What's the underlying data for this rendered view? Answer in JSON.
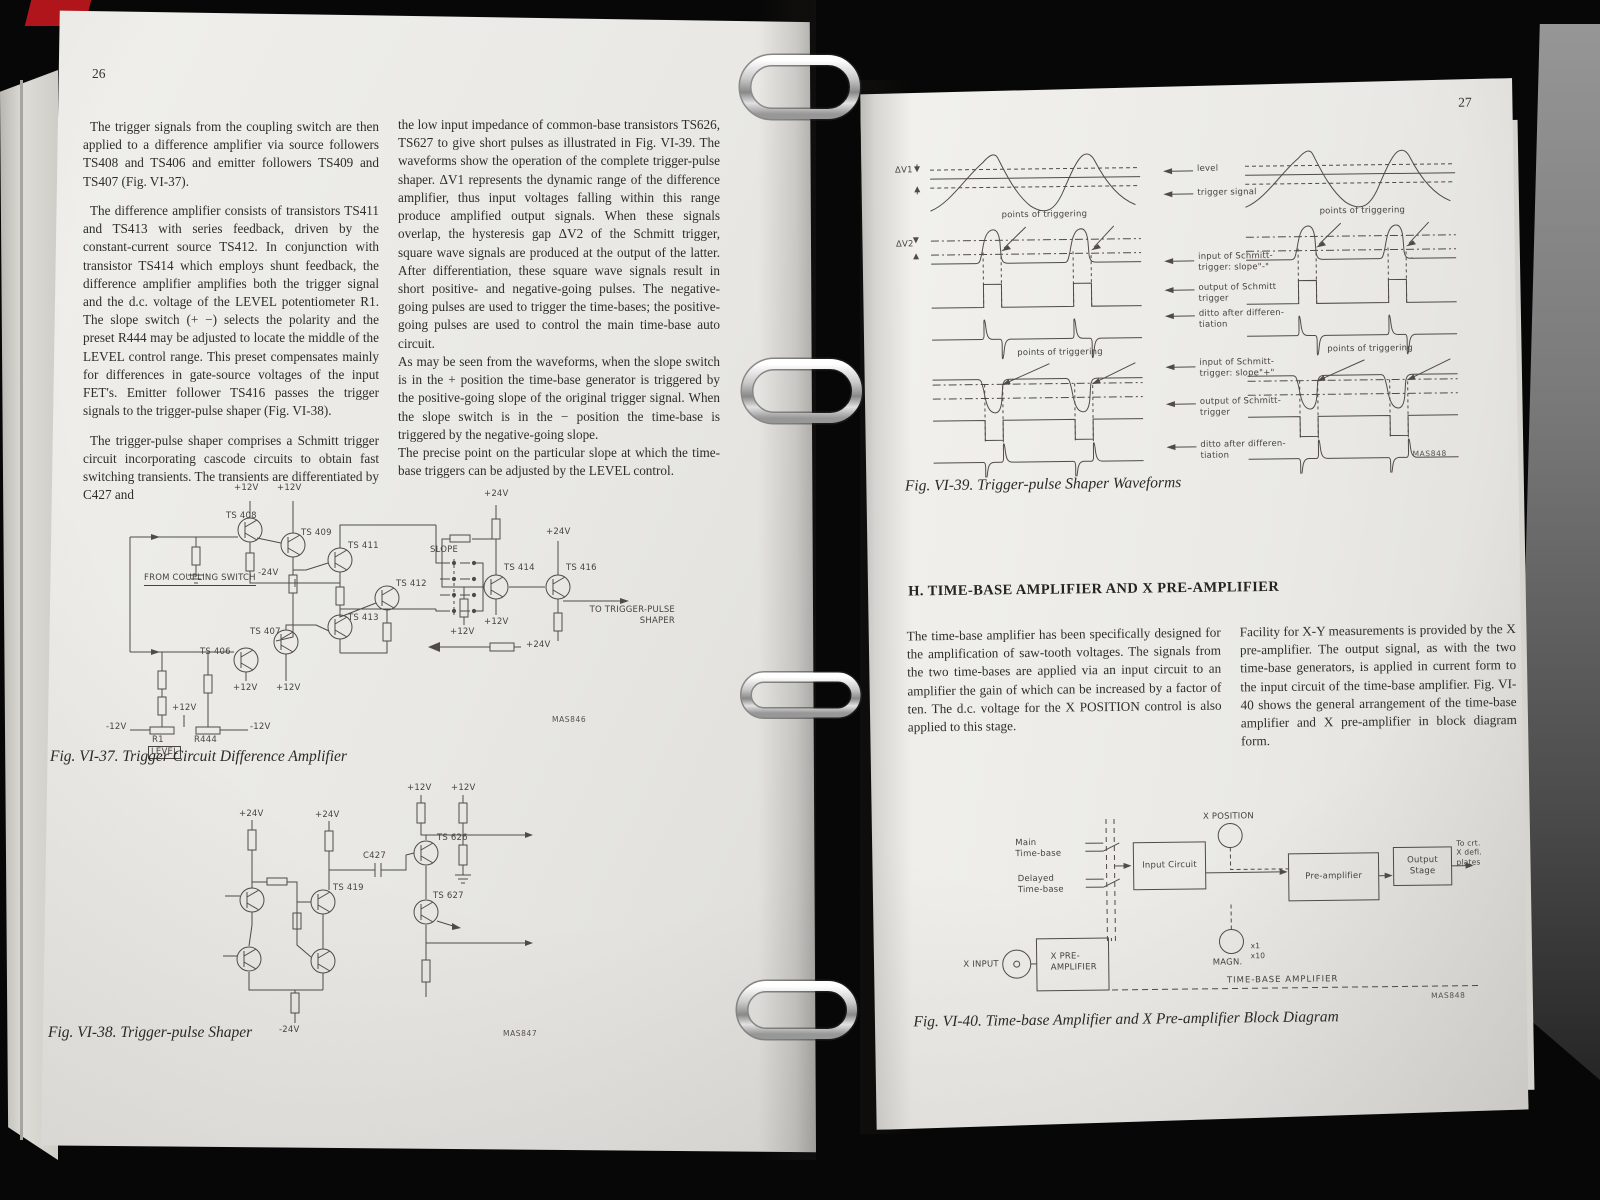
{
  "colors": {
    "binder_red": "#b0151c",
    "page": "#eae9e5",
    "background": "#070707",
    "ring_silver": "#c9c9c9"
  },
  "left_page": {
    "page_number": "26",
    "col1": [
      "The trigger signals from the coupling switch are then applied to a difference amplifier via source followers TS408 and TS406 and emitter followers TS409 and TS407 (Fig. VI-37).",
      "The difference amplifier consists of transistors TS411 and TS413 with series feedback, driven by the constant-current source TS412. In conjunction with transistor TS414 which employs shunt feedback, the difference amplifier amplifies both the trigger signal and the d.c. voltage of the LEVEL potentiometer R1. The slope switch (+ −) selects the polarity and the preset R444 may be adjusted to locate the middle of the LEVEL control range. This preset compensates mainly for differences in gate-source voltages of the input FET's. Emitter follower TS416 passes the trigger signals to the trigger-pulse shaper (Fig. VI-38).",
      "The trigger-pulse shaper comprises a Schmitt trigger circuit incorporating cascode circuits to obtain fast switching transients. The transients are differentiated by C427 and"
    ],
    "col2": [
      "the low input impedance of common-base transistors TS626, TS627 to give short pulses as illustrated in Fig. VI-39. The waveforms show the operation of the complete trigger-pulse shaper. ΔV1 represents the dynamic range of the difference amplifier, thus input voltages falling within this range produce amplified output signals. When these signals overlap, the hysteresis gap ΔV2 of the Schmitt trigger, square wave signals are produced at the output of the latter. After differentiation, these square wave signals result in short positive- and negative-going pulses. The negative-going pulses are used to trigger the time-bases; the positive-going pulses are used to control the main time-base auto circuit.",
      "As may be seen from the waveforms, when the slope switch is in the + position the time-base generator is triggered by the positive-going slope of the original trigger signal. When the slope switch is in the − position the time-base is triggered by the negative-going slope.",
      "The precise point on the particular slope at which the time-base triggers can be adjusted by the LEVEL control."
    ],
    "fig37": {
      "caption": "Fig. VI-37. Trigger Circuit Difference Amplifier",
      "code": "MAS846",
      "labels": {
        "from_coupling_switch": "FROM COUPLING SWITCH",
        "ts408": "TS 408",
        "ts409": "TS 409",
        "ts411": "TS 411",
        "ts412": "TS 412",
        "ts413": "TS 413",
        "ts406": "TS 406",
        "ts407": "TS 407",
        "ts414": "TS 414",
        "ts416": "TS 416",
        "slope": "SLOPE",
        "to_shaper": "TO TRIGGER-PULSE\nSHAPER",
        "v12p": "+12V",
        "v12n": "-12V",
        "v24p": "+24V",
        "v24n": "-24V",
        "r1": "R1",
        "r444": "R444",
        "level": "LEVEL"
      }
    },
    "fig38": {
      "caption": "Fig. VI-38. Trigger-pulse Shaper",
      "code": "MAS847",
      "labels": {
        "c427": "C427",
        "ts419": "TS 419",
        "ts626": "TS 626",
        "ts627": "TS 627",
        "v24p": "+24V",
        "v12p": "+12V",
        "v24n": "-24V"
      }
    }
  },
  "right_page": {
    "page_number": "27",
    "fig39": {
      "caption": "Fig. VI-39. Trigger-pulse Shaper Waveforms",
      "code": "MAS848",
      "labels": {
        "dv1": "ΔV1",
        "dv2": "ΔV2",
        "level": "level",
        "trigger_signal": "trigger signal",
        "points_of_triggering": "points of triggering",
        "input_slope_minus": "input of Schmitt-\ntrigger: slope\"-\"",
        "output_schmitt": "output of Schmitt\ntrigger",
        "ditto": "ditto after differen-\ntiation",
        "input_slope_plus": "input of Schmitt-\ntrigger: slope\"+\"",
        "output_schmitt2": "output of Schmitt-\ntrigger",
        "minus_switch": "-"
      }
    },
    "section_h": {
      "heading": "H. TIME-BASE AMPLIFIER AND X PRE-AMPLIFIER",
      "col1": "The time-base amplifier has been specifically designed for the amplification of saw-tooth voltages. The signals from the two time-bases are applied via an input circuit to an amplifier the gain of which can be increased by a factor of ten. The d.c. voltage for the X POSITION control is also applied to this stage.",
      "col2": "Facility for X-Y measurements is provided by the X pre-amplifier. The output signal, as with the two time-base generators, is applied in current form to the input circuit of the time-base amplifier. Fig. VI-40 shows the general arrangement of the time-base amplifier and X pre-amplifier in block diagram form."
    },
    "fig40": {
      "caption": "Fig. VI-40. Time-base Amplifier and X Pre-amplifier  Block Diagram",
      "code": "MAS848",
      "labels": {
        "main_time_base": "Main\nTime-base",
        "delayed_time_base": "Delayed\nTime-base",
        "input_circuit": "Input Circuit",
        "x_position": "X POSITION",
        "pre_amplifier": "Pre-amplifier",
        "output_stage": "Output Stage",
        "to_crt": "To crt.\nX defl.\nplates",
        "magn": "MAGN.",
        "x1": "x1",
        "x10": "x10",
        "x_input": "X INPUT",
        "x_pre_amplifier": "X PRE-\nAMPLIFIER",
        "time_base_amplifier": "TIME-BASE  AMPLIFIER"
      }
    }
  }
}
